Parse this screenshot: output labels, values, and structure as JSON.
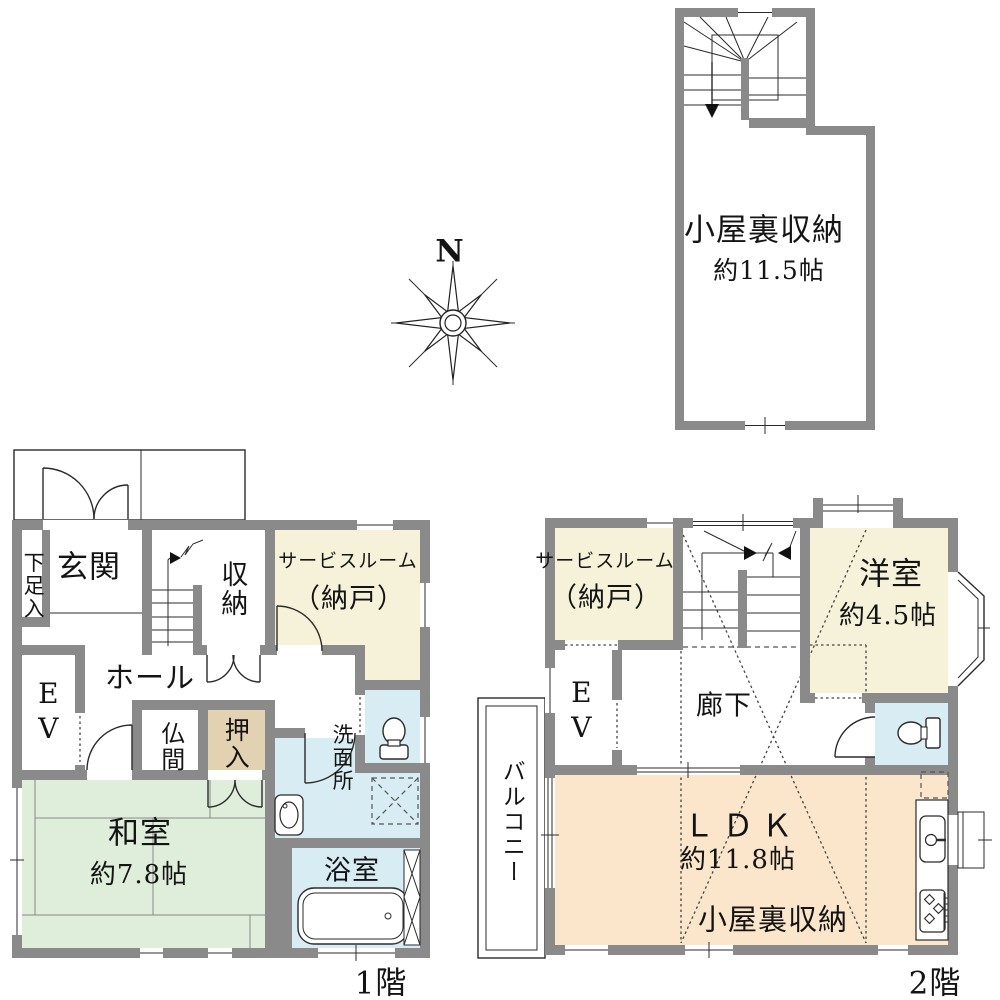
{
  "compass": {
    "north_label": "N"
  },
  "attic": {
    "name": "小屋裏収納",
    "size": "約11.5帖"
  },
  "floor1": {
    "label": "1階",
    "rooms": {
      "geta": "下足入",
      "genkan": "玄関",
      "shuno": "収納",
      "service_line1": "サービスルーム",
      "service_line2": "（納戸）",
      "ev": "EV",
      "hall": "ホール",
      "butsuma": "仏間",
      "oshiire": "押入",
      "washitsu": "和室",
      "washitsu_size": "約7.8帖",
      "senmenjo": "洗面所",
      "yokushitsu": "浴室"
    }
  },
  "floor2": {
    "label": "2階",
    "rooms": {
      "service_line1": "サービスルーム",
      "service_line2": "（納戸）",
      "yoshitsu": "洋室",
      "yoshitsu_size": "約4.5帖",
      "ev": "EV",
      "rouka": "廊下",
      "balcony": "バルコニー",
      "ldk": "ＬＤＫ",
      "ldk_size": "約11.8帖",
      "attic_label": "小屋裏収納"
    }
  },
  "colors": {
    "wall": "#8a8a8a",
    "tatami_green": "#dfeeda",
    "closet_tan": "#e2d2b2",
    "wet_blue": "#d8ecf4",
    "service_cream": "#f6f2da",
    "ldk_peach": "#fbe6cc"
  }
}
